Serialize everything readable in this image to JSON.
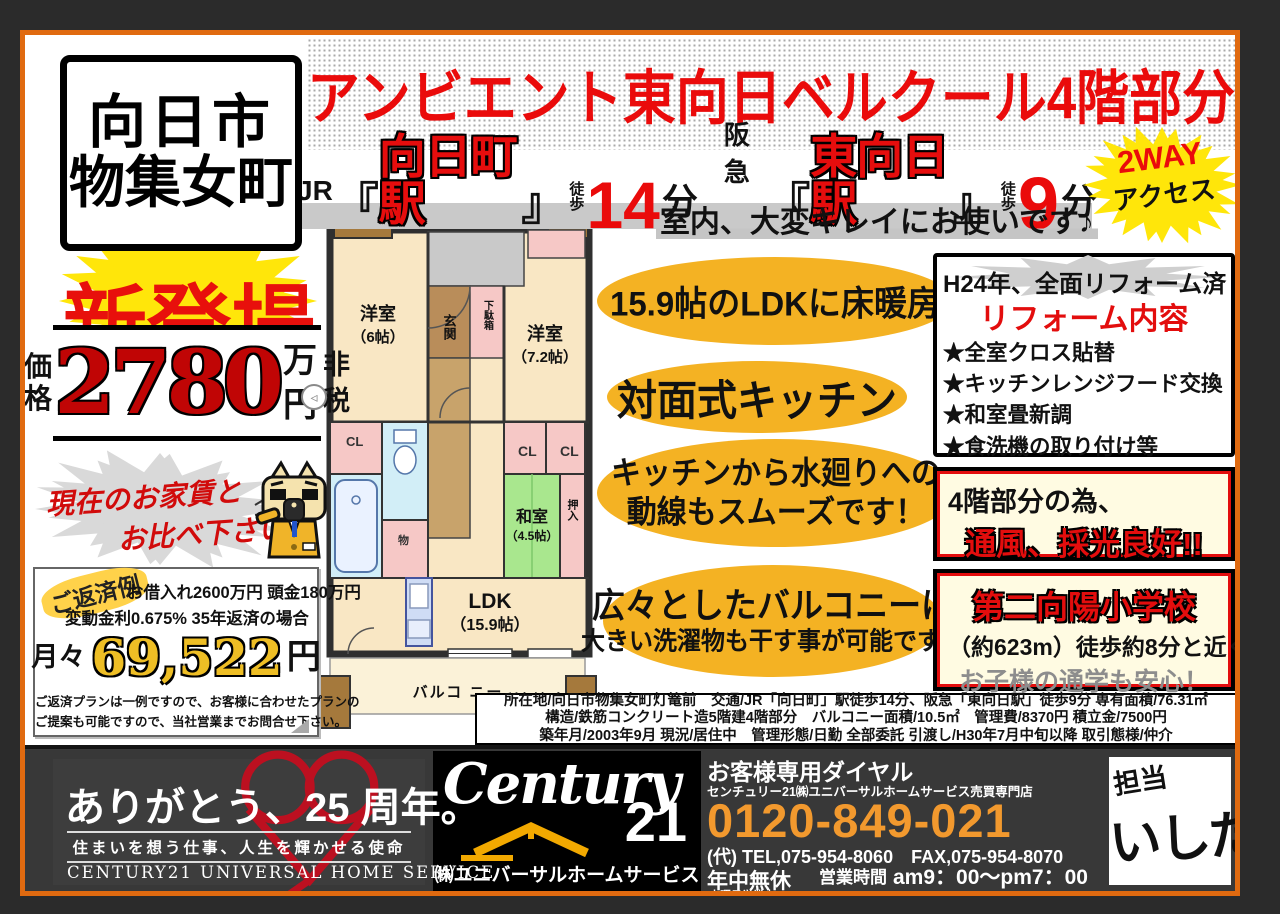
{
  "header": {
    "location_line1": "向日市",
    "location_line2": "物集女町",
    "title": "アンビエント東向日ベルクール4階部分",
    "st1_company": "JR",
    "st1_open": "『",
    "st1_name": "向日町駅",
    "st1_close": "』",
    "st1_walk1": "徒",
    "st1_walk2": "歩",
    "st1_min": "14",
    "st1_unit": "分",
    "st2_company": "阪急",
    "st2_open": "『",
    "st2_name": "東向日駅",
    "st2_close": "』",
    "st2_walk1": "徒",
    "st2_walk2": "歩",
    "st2_min": "9",
    "st2_unit": "分",
    "access_line1": "2WAY",
    "access_line2": "アクセス",
    "condition_note": "室内、大変キレイにお使いです♪"
  },
  "left": {
    "new_badge": "新登場",
    "price_label1": "価",
    "price_label2": "格",
    "price_value": "2780",
    "price_unit1": "万",
    "price_unit2": "円",
    "price_tax1": "非",
    "price_tax2": "税",
    "rent_line1": "現在のお家賃と",
    "rent_line2": "お比べ下さい!!",
    "repay_label": "ご返済例",
    "repay_line1": "お借入れ2600万円 頭金180万円",
    "repay_line2": "変動金利0.675%  35年返済の場合",
    "monthly_prefix": "月々",
    "monthly_value": "69,522",
    "monthly_unit": "円",
    "repay_note1": "ご返済プランは一例ですので、お客様に合わせたプランの",
    "repay_note2": "ご提案も可能ですので、当社営業までお問合せ下さい。"
  },
  "floorplan": {
    "yoshitsu1": "洋室",
    "yoshitsu1_size": "（6帖）",
    "genkan": "玄関",
    "getabako": "下駄箱",
    "yoshitsu2": "洋室",
    "yoshitsu2_size": "（7.2帖）",
    "cl": "CL",
    "mono": "物",
    "washitsu": "和室",
    "washitsu_size": "（4.5帖）",
    "oshiire": "押入",
    "ldk": "LDK",
    "ldk_size": "（15.9帖）",
    "balcony": "バルコ ニー"
  },
  "features": {
    "f1": "15.9帖のLDKに床暖房",
    "f2": "対面式キッチン",
    "f3_line1": "キッチンから水廻りへの",
    "f3_line2": "動線もスムーズです！",
    "f4_line1": "広々としたバルコニーは",
    "f4_line2": "大きい洗濯物も干す事が可能です！"
  },
  "reform": {
    "header": "H24年、全面リフォーム済",
    "title": "リフォーム内容",
    "items": [
      "★全室クロス貼替",
      "★キッチンレンジフード交換",
      "★和室畳新調",
      "★食洗機の取り付け等"
    ]
  },
  "boxes": {
    "floor_line1": "4階部分の為、",
    "floor_line2": "通風、採光良好!!",
    "school_line1": "第二向陽小学校",
    "school_line2": "（約623m）徒歩約8分と近く",
    "school_line3": "お子様の通学も安心！"
  },
  "details": {
    "line1": "所在地/向日市物集女町灯篭前　交通/JR「向日町」駅徒歩14分、阪急「東向日駅」徒歩9分 専有面積/76.31㎡",
    "line2": "構造/鉄筋コンクリート造5階建4階部分　バルコニー面積/10.5㎡　管理費/8370円 積立金/7500円",
    "line3": "築年月/2003年9月 現況/居住中　管理形態/日勤 全部委託 引渡し/H30年7月中旬以降 取引態様/仲介"
  },
  "footer": {
    "thanks_title": "ありがとう、25 周年。",
    "thanks_sub": "住まいを想う仕事、人生を輝かせる使命",
    "thanks_en": "CENTURY21 UNIVERSAL HOME SERVICE",
    "logo_script": "Century",
    "logo_21": "21",
    "logo_company": "㈱ユニバーサルホームサービス",
    "dial_label": "お客様専用ダイヤル",
    "dial_sub": "センチュリー21㈱ユニバーサルホームサービス売買専門店",
    "phone": "0120-849-021",
    "telfax": "(代)  TEL,075-954-8060　FAX,075-954-8070",
    "open_label": "年中無休",
    "open_sub": "水曜日営業中",
    "hours_label": "営業時間",
    "hours": "am9：00～pm7：00",
    "license": "京都府知事免許(6)第9738号",
    "ad_expiry": "【広告有効期限　平成30年6月18日】",
    "staff_label": "担当",
    "staff_name": "いしだ"
  },
  "colors": {
    "accent_red": "#ea0b0b",
    "burst_yellow": "#ffe60a",
    "highlight_orange": "#f4b223",
    "frame_orange": "#e06a10",
    "phone_orange": "#f2992e"
  }
}
